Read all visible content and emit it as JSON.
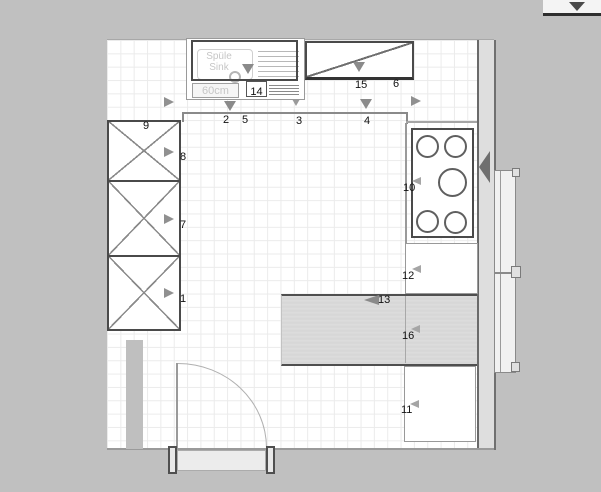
{
  "plan_type": "kitchen-floor-plan",
  "labels": {
    "n1": "1",
    "n2": "2",
    "n3": "3",
    "n4": "4",
    "n5": "5",
    "n6": "6",
    "n7": "7",
    "n8": "8",
    "n9": "9",
    "n10": "10",
    "n11": "11",
    "n12": "12",
    "n13": "13",
    "n14": "14",
    "n15": "15",
    "n16": "16"
  },
  "sink": {
    "name_line1": "Spüle",
    "name_line2": "Sink",
    "size": "60cm"
  },
  "items": {
    "tall_cabinets": [
      "9",
      "7",
      "1"
    ],
    "wall_cabinets": [
      "14 (sink wall cabinet)",
      "15 / 6"
    ],
    "cooktop": "10",
    "base_cabinets": [
      "12",
      "11"
    ],
    "worktop": "16",
    "worktop_edge_marker": "13"
  },
  "icons": {
    "direction_arrows": [
      "down",
      "right",
      "left"
    ],
    "dropdown": "down-triangle"
  },
  "colors": {
    "background": "#c0c0c0",
    "floor": "#ffffff",
    "grid": "#ebebeb",
    "wall_strip": "#dedede",
    "outline": "#4a4a4a",
    "worktop_stripe": "#d8d8d8",
    "arrow": "#8f8f8f",
    "faint_text": "#c6c6c6"
  }
}
